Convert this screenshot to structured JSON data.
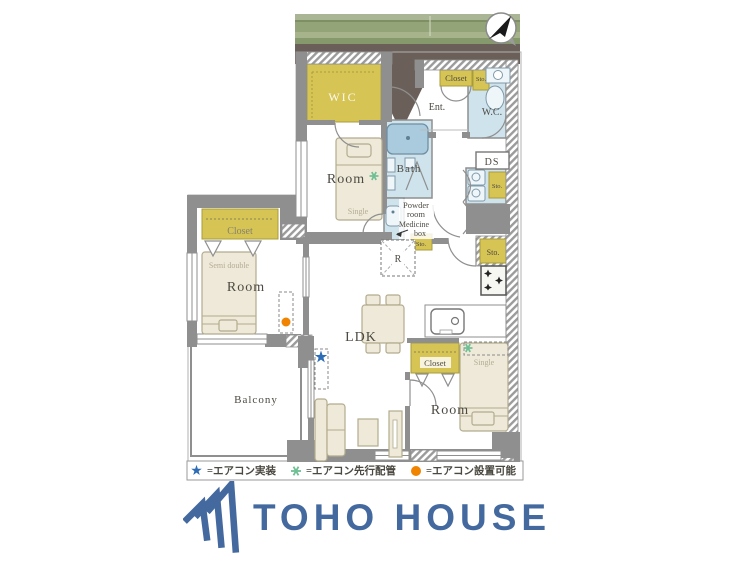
{
  "floorplan": {
    "labels": {
      "wic": "WIC",
      "room_top": "Room",
      "single_top": "Single",
      "ent": "Ent.",
      "closet_ent": "Closet",
      "sto_ent": "Sto.",
      "wc": "W.C.",
      "bath": "Bath",
      "powder_line1": "Powder",
      "powder_line2": "room",
      "medicine_line1": "Medicine",
      "medicine_line2": "box",
      "sto_powder": "Sto.",
      "ds": "DS",
      "sto_washer": "Sto.",
      "sto_kitchen": "Sto.",
      "fridge": "R",
      "closet_left": "Closet",
      "semi_double": "Semi double",
      "room_left": "Room",
      "ldk": "LDK",
      "closet_bottom": "Closet",
      "single_bottom": "Single",
      "room_bottom": "Room",
      "balcony": "Balcony"
    },
    "legend": {
      "star_label": "=エアコン実装",
      "asterisk_label": "=エアコン先行配管",
      "circle_label": "=エアコン設置可能",
      "star_color": "#2e6db6",
      "asterisk_color": "#6fbf94",
      "circle_color": "#f08300"
    }
  },
  "branding": {
    "logo_text": "TOHO HOUSE",
    "logo_color": "#44699f"
  }
}
